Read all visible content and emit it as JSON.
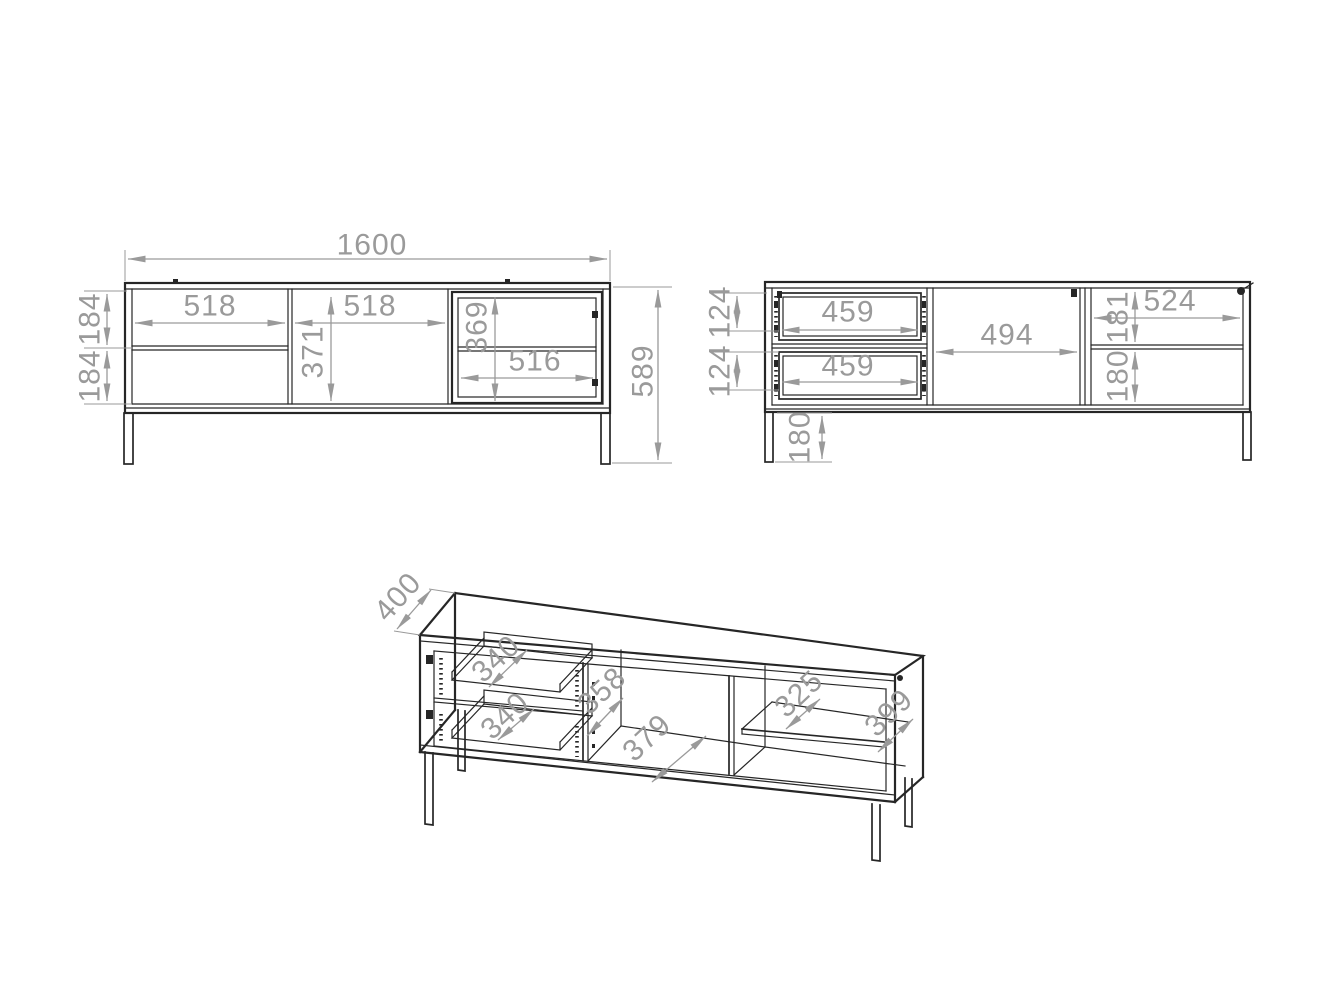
{
  "colors": {
    "background": "#ffffff",
    "outline": "#262626",
    "dimension": "#9a9a9a"
  },
  "front_view": {
    "overall_width": "1600",
    "overall_height": "589",
    "left_drawer_width": "518",
    "door_width": "518",
    "door_height": "371",
    "upper_drawer_front_height": "184",
    "lower_drawer_front_height": "184",
    "glass_compartment_height": "369",
    "glass_compartment_width": "516"
  },
  "back_view": {
    "upper_drawer_box_width": "459",
    "lower_drawer_box_width": "459",
    "upper_drawer_box_height": "124",
    "lower_drawer_box_height": "124",
    "middle_compartment_width": "494",
    "right_compartment_width": "524",
    "right_upper_compartment_height": "181",
    "right_lower_compartment_height": "180",
    "leg_height": "180"
  },
  "perspective_view": {
    "overall_depth": "400",
    "upper_drawer_depth": "340",
    "lower_drawer_depth": "340",
    "partition_depth": "358",
    "middle_floor_depth": "379",
    "shelf_depth": "325",
    "side_panel_depth": "399"
  }
}
